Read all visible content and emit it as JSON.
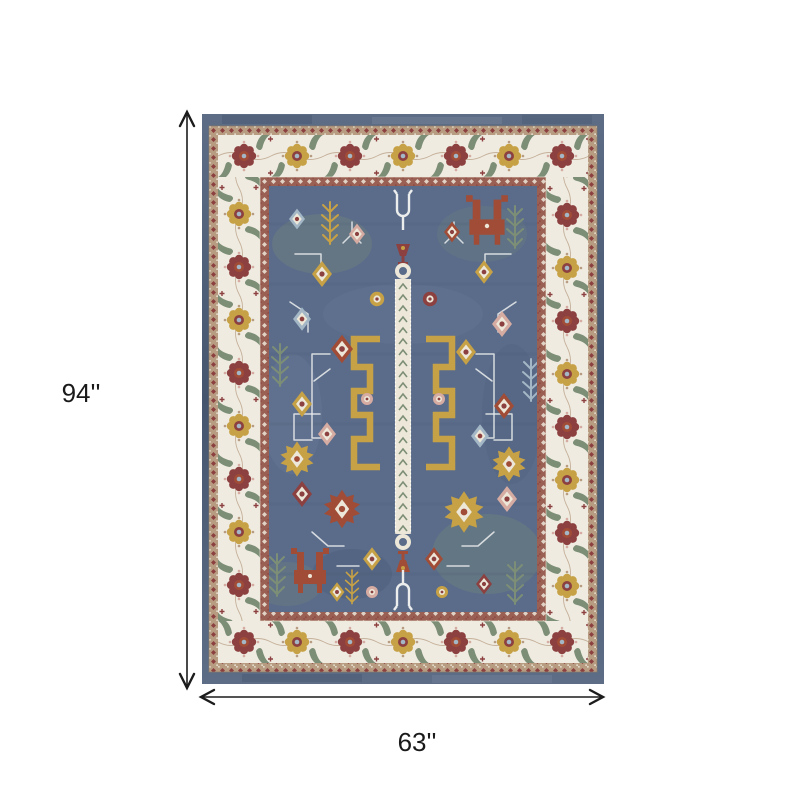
{
  "page": {
    "background_color": "#ffffff"
  },
  "diagram": {
    "height_label": "94''",
    "width_label": "63''",
    "line_color": "#1c1c1c",
    "label_color": "#1a1a1a"
  },
  "rug": {
    "colors": {
      "denim": "#5e6d86",
      "denim_dark": "#45556e",
      "denim_light": "#8a97ab",
      "trim_tan": "#b79c82",
      "trim_red": "#9a6053",
      "ivory": "#efebe0",
      "field_blue": "#5a6c8a",
      "field_light": "#8496ac",
      "field_dark": "#46566f",
      "sage": "#7c8e76",
      "gold": "#c7a145",
      "gold_dark": "#a3823a",
      "rust": "#a14c36",
      "maroon": "#8c4140",
      "pink": "#d6aba1",
      "light_blue": "#a3b7c6",
      "cream": "#ece7d8",
      "white_line": "#eceeee"
    }
  }
}
